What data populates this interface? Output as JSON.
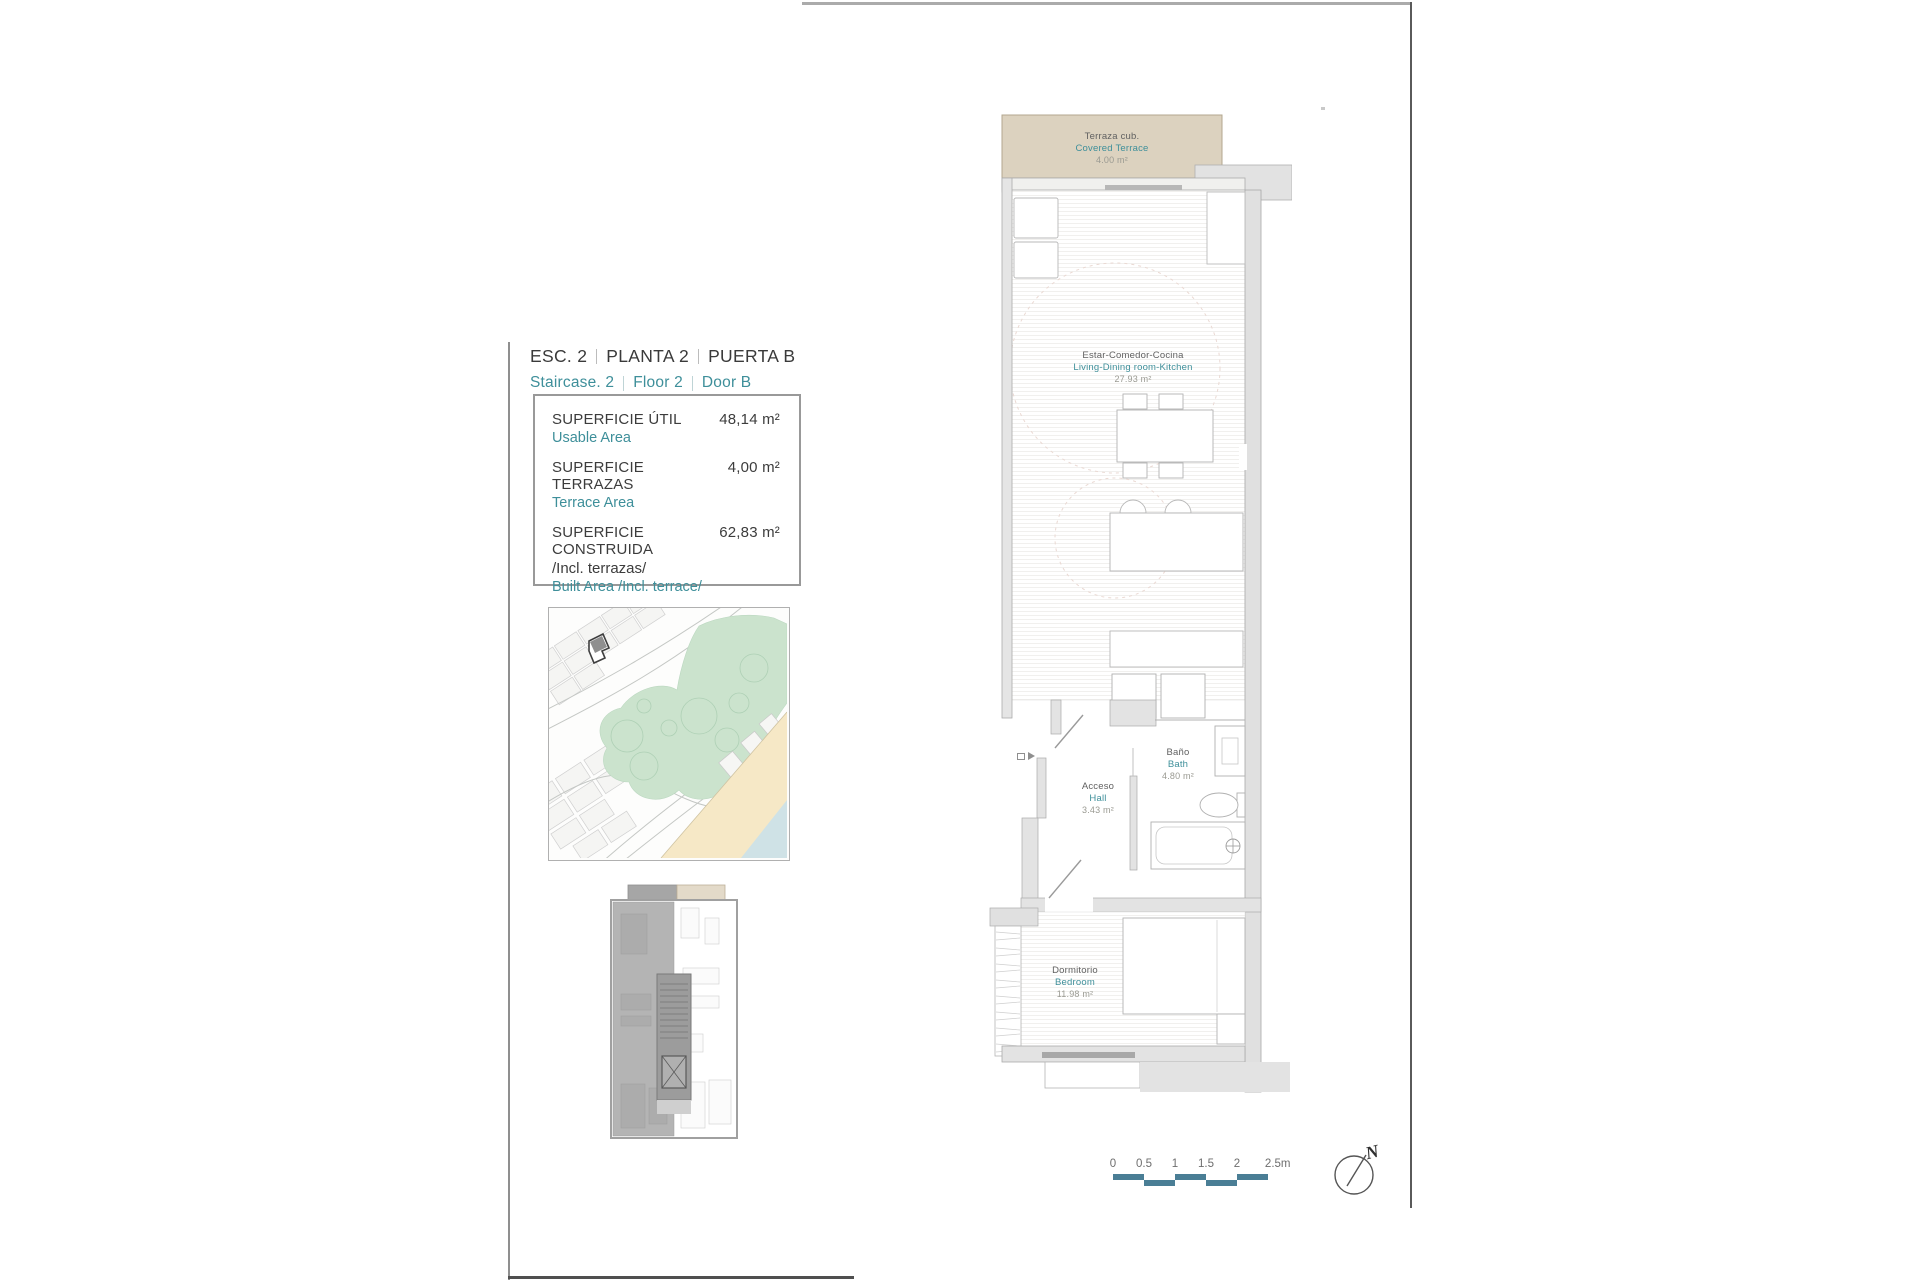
{
  "colors": {
    "teal": "#3E8F9A",
    "scalebar": "#4A7E95",
    "terrace": "#DCD2BF",
    "park": "#CBE3CD",
    "sand": "#F6E8C6",
    "water": "#CFE2E6",
    "wall": "#E3E3E3",
    "wall-dark": "#B7B7B7"
  },
  "header": {
    "line1": [
      "ESC. 2",
      "PLANTA 2",
      "PUERTA B"
    ],
    "line2": [
      "Staircase. 2",
      "Floor 2",
      "Door B"
    ]
  },
  "areas": {
    "rows": [
      {
        "es": "SUPERFICIE ÚTIL",
        "en": "Usable Area",
        "value": "48,14 m²"
      },
      {
        "es": "SUPERFICIE TERRAZAS",
        "en": "Terrace Area",
        "value": "4,00 m²"
      },
      {
        "es": "SUPERFICIE CONSTRUIDA",
        "es2": "/Incl. terrazas/",
        "en": "Built Area /Incl. terrace/",
        "value": "62,83 m²"
      }
    ]
  },
  "rooms": {
    "terrace": {
      "es": "Terraza cub.",
      "en": "Covered Terrace",
      "area": "4.00 m²"
    },
    "living": {
      "es": "Estar-Comedor-Cocina",
      "en": "Living-Dining room-Kitchen",
      "area": "27.93 m²"
    },
    "bath": {
      "es": "Baño",
      "en": "Bath",
      "area": "4.80 m²"
    },
    "hall": {
      "es": "Acceso",
      "en": "Hall",
      "area": "3.43 m²"
    },
    "bedroom": {
      "es": "Dormitorio",
      "en": "Bedroom",
      "area": "11.98 m²"
    }
  },
  "scalebar": {
    "ticks": [
      "0",
      "0.5",
      "1",
      "1.5",
      "2",
      "2.5m"
    ]
  },
  "compass": {
    "label": "N"
  }
}
